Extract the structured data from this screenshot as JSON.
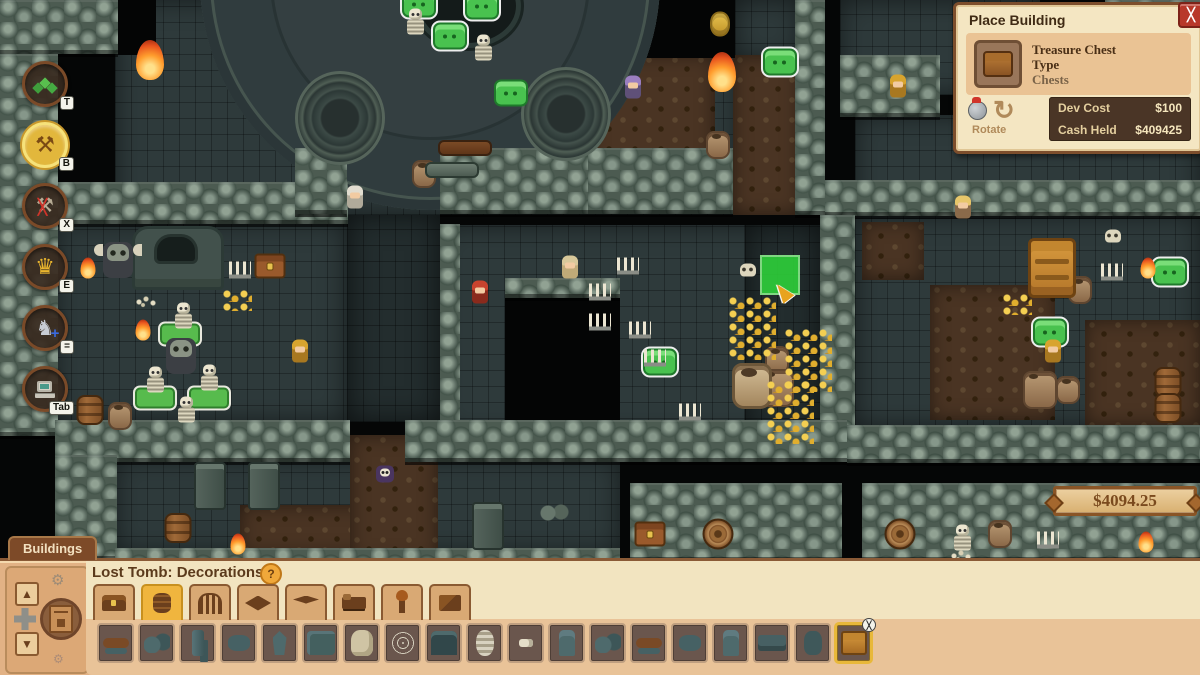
{
  "place_building_panel": {
    "title": "Place Building",
    "close_label": "╳",
    "item": {
      "line1": "Treasure Chest",
      "line2": "Type",
      "line3": "Chests"
    },
    "rotate_label": "Rotate",
    "rotate_glyph": "↻",
    "costs": [
      {
        "label": "Dev Cost",
        "value": "$100"
      },
      {
        "label": "Cash Held",
        "value": "$409425"
      }
    ]
  },
  "money_badge": {
    "amount": "$4094.25"
  },
  "toolbar": {
    "items": [
      {
        "id": "terrain",
        "glyph": "◆",
        "hotkey": "T",
        "selected": false
      },
      {
        "id": "build",
        "glyph": "⚒",
        "hotkey": "B",
        "selected": true
      },
      {
        "id": "demolish",
        "glyph": "⚒",
        "hotkey": "X",
        "selected": false
      },
      {
        "id": "crown",
        "glyph": "♛",
        "hotkey": "E",
        "selected": false
      },
      {
        "id": "knight",
        "glyph": "♞",
        "hotkey": "=",
        "selected": false
      },
      {
        "id": "computer",
        "glyph": "",
        "hotkey": "Tab",
        "selected": false
      }
    ]
  },
  "buildings_panel": {
    "tab_label": "Buildings",
    "header": "Lost Tomb: Decorations",
    "help_icon": "?",
    "gear_icon": "⚙",
    "arrow_up": "▲",
    "arrow_down": "▼",
    "categories": [
      {
        "id": "chests",
        "selected": false
      },
      {
        "id": "barrels",
        "selected": true
      },
      {
        "id": "gates",
        "selected": false
      },
      {
        "id": "carpets",
        "selected": false
      },
      {
        "id": "floors",
        "selected": false
      },
      {
        "id": "beds",
        "selected": false
      },
      {
        "id": "torches",
        "selected": false
      },
      {
        "id": "walls",
        "selected": false
      }
    ],
    "items": [
      {
        "variant": "log",
        "selected": false
      },
      {
        "variant": "rubble",
        "selected": false
      },
      {
        "variant": "pillar",
        "selected": false
      },
      {
        "variant": "rock",
        "selected": false
      },
      {
        "variant": "obelisk",
        "selected": false
      },
      {
        "variant": "wall",
        "selected": false
      },
      {
        "variant": "pelt",
        "selected": false
      },
      {
        "variant": "web",
        "selected": false
      },
      {
        "variant": "gate",
        "selected": false
      },
      {
        "variant": "swirl",
        "selected": false
      },
      {
        "variant": "tiny",
        "selected": false
      },
      {
        "variant": "statue",
        "selected": false
      },
      {
        "variant": "rubble",
        "selected": false
      },
      {
        "variant": "log",
        "selected": false
      },
      {
        "variant": "rock",
        "selected": false
      },
      {
        "variant": "statue",
        "selected": false
      },
      {
        "variant": "slab",
        "selected": false
      },
      {
        "variant": "sack",
        "selected": false
      },
      {
        "variant": "chest",
        "selected": true,
        "badge": "╳"
      }
    ]
  },
  "map": {
    "accent_colors": {
      "slime_green": "#49c24f",
      "placement_green": "#2ed43a",
      "gold": "#e0ae2e"
    },
    "floors": [
      {
        "x": 115,
        "y": 0,
        "w": 625,
        "h": 215,
        "k": "stone"
      },
      {
        "x": 590,
        "y": 55,
        "w": 125,
        "h": 115,
        "k": "dirt"
      },
      {
        "x": 735,
        "y": 0,
        "w": 65,
        "h": 60,
        "k": "stone"
      },
      {
        "x": 733,
        "y": 55,
        "w": 67,
        "h": 160,
        "k": "dirt"
      },
      {
        "x": 840,
        "y": 0,
        "w": 200,
        "h": 95,
        "k": "stone"
      },
      {
        "x": 855,
        "y": 115,
        "w": 345,
        "h": 100,
        "k": "stone"
      },
      {
        "x": 55,
        "y": 222,
        "w": 292,
        "h": 200,
        "k": "stone"
      },
      {
        "x": 347,
        "y": 215,
        "w": 93,
        "h": 207,
        "k": "stonedark"
      },
      {
        "x": 440,
        "y": 225,
        "w": 415,
        "h": 210,
        "k": "stone"
      },
      {
        "x": 745,
        "y": 225,
        "w": 75,
        "h": 210,
        "k": "stonedark"
      },
      {
        "x": 855,
        "y": 215,
        "w": 345,
        "h": 212,
        "k": "stone"
      },
      {
        "x": 930,
        "y": 285,
        "w": 125,
        "h": 135,
        "k": "dirt"
      },
      {
        "x": 1085,
        "y": 320,
        "w": 115,
        "h": 105,
        "k": "dirt"
      },
      {
        "x": 862,
        "y": 222,
        "w": 62,
        "h": 58,
        "k": "dirt"
      },
      {
        "x": 115,
        "y": 458,
        "w": 505,
        "h": 95,
        "k": "stone"
      },
      {
        "x": 240,
        "y": 505,
        "w": 175,
        "h": 50,
        "k": "dirt"
      },
      {
        "x": 350,
        "y": 435,
        "w": 88,
        "h": 125,
        "k": "dirt"
      },
      {
        "x": 118,
        "y": 0,
        "w": 38,
        "h": 55,
        "k": "dark"
      },
      {
        "x": 640,
        "y": 0,
        "w": 95,
        "h": 58,
        "k": "dark"
      },
      {
        "x": 1040,
        "y": 0,
        "w": 65,
        "h": 90,
        "k": "dark"
      },
      {
        "x": 505,
        "y": 295,
        "w": 115,
        "h": 140,
        "k": "dark"
      }
    ],
    "walls": [
      {
        "x": 0,
        "y": 0,
        "w": 118,
        "h": 54
      },
      {
        "x": 0,
        "y": 54,
        "w": 58,
        "h": 382
      },
      {
        "x": 58,
        "y": 182,
        "w": 290,
        "h": 42
      },
      {
        "x": 295,
        "y": 148,
        "w": 52,
        "h": 66
      },
      {
        "x": 440,
        "y": 148,
        "w": 148,
        "h": 66
      },
      {
        "x": 588,
        "y": 148,
        "w": 145,
        "h": 66
      },
      {
        "x": 795,
        "y": 0,
        "w": 30,
        "h": 215
      },
      {
        "x": 825,
        "y": 180,
        "w": 375,
        "h": 36
      },
      {
        "x": 840,
        "y": 55,
        "w": 100,
        "h": 62
      },
      {
        "x": 1105,
        "y": 0,
        "w": 95,
        "h": 95
      },
      {
        "x": 440,
        "y": 224,
        "w": 20,
        "h": 200
      },
      {
        "x": 820,
        "y": 215,
        "w": 35,
        "h": 220
      },
      {
        "x": 505,
        "y": 278,
        "w": 115,
        "h": 20
      },
      {
        "x": 55,
        "y": 420,
        "w": 295,
        "h": 42
      },
      {
        "x": 405,
        "y": 420,
        "w": 442,
        "h": 42
      },
      {
        "x": 847,
        "y": 425,
        "w": 353,
        "h": 38
      },
      {
        "x": 55,
        "y": 455,
        "w": 62,
        "h": 105
      },
      {
        "x": 630,
        "y": 483,
        "w": 212,
        "h": 78
      },
      {
        "x": 862,
        "y": 483,
        "w": 338,
        "h": 78
      },
      {
        "x": 115,
        "y": 548,
        "w": 505,
        "h": 20
      }
    ],
    "sprites": [
      {
        "t": "arena",
        "x": 430,
        "y": -20
      },
      {
        "t": "altar",
        "x": 468,
        "y": 6
      },
      {
        "t": "tower",
        "x": 340,
        "y": 118
      },
      {
        "t": "tower",
        "x": 566,
        "y": 114
      },
      {
        "t": "slime",
        "x": 419,
        "y": 4
      },
      {
        "t": "slime",
        "x": 482,
        "y": 6
      },
      {
        "t": "slime",
        "x": 450,
        "y": 36
      },
      {
        "t": "slime",
        "x": 511,
        "y": 93,
        "m": "plain"
      },
      {
        "t": "slime",
        "x": 780,
        "y": 62
      },
      {
        "t": "slime",
        "x": 660,
        "y": 362
      },
      {
        "t": "slime",
        "x": 1050,
        "y": 332
      },
      {
        "t": "slime",
        "x": 1170,
        "y": 272
      },
      {
        "t": "skeleton",
        "x": 415,
        "y": 22
      },
      {
        "t": "skeleton",
        "x": 483,
        "y": 48
      },
      {
        "t": "skeleton",
        "x": 183,
        "y": 316
      },
      {
        "t": "skeleton",
        "x": 155,
        "y": 380
      },
      {
        "t": "skeleton",
        "x": 209,
        "y": 378
      },
      {
        "t": "skeleton",
        "x": 186,
        "y": 410
      },
      {
        "t": "skeleton",
        "x": 962,
        "y": 538
      },
      {
        "t": "slab",
        "x": 180,
        "y": 334
      },
      {
        "t": "slab",
        "x": 155,
        "y": 398
      },
      {
        "t": "slab",
        "x": 209,
        "y": 398
      },
      {
        "t": "tomb",
        "x": 178,
        "y": 258
      },
      {
        "t": "skullstatue",
        "x": 118,
        "y": 260,
        "m": "winged"
      },
      {
        "t": "skullstatue",
        "x": 181,
        "y": 356
      },
      {
        "t": "chestwood",
        "x": 270,
        "y": 266
      },
      {
        "t": "chestwood",
        "x": 650,
        "y": 534
      },
      {
        "t": "chestgold",
        "x": 1052,
        "y": 268
      },
      {
        "t": "barrel",
        "x": 90,
        "y": 410
      },
      {
        "t": "barrel",
        "x": 178,
        "y": 528
      },
      {
        "t": "barrel",
        "x": 1168,
        "y": 382
      },
      {
        "t": "barrel",
        "x": 1168,
        "y": 408
      },
      {
        "t": "barrel",
        "x": 718,
        "y": 534,
        "m": "top"
      },
      {
        "t": "barrel",
        "x": 900,
        "y": 534,
        "m": "top"
      },
      {
        "t": "pot",
        "x": 120,
        "y": 416
      },
      {
        "t": "pot",
        "x": 424,
        "y": 174
      },
      {
        "t": "pot",
        "x": 718,
        "y": 145
      },
      {
        "t": "pot",
        "x": 777,
        "y": 360
      },
      {
        "t": "pot",
        "x": 777,
        "y": 388,
        "m": "big"
      },
      {
        "t": "pot",
        "x": 1080,
        "y": 290
      },
      {
        "t": "pot",
        "x": 1040,
        "y": 390,
        "m": "big"
      },
      {
        "t": "pot",
        "x": 1068,
        "y": 390
      },
      {
        "t": "pot",
        "x": 1000,
        "y": 534
      },
      {
        "t": "urn",
        "x": 752,
        "y": 386
      },
      {
        "t": "gold",
        "x": 752,
        "y": 328,
        "m": "big"
      },
      {
        "t": "gold",
        "x": 808,
        "y": 360,
        "m": "big"
      },
      {
        "t": "gold",
        "x": 790,
        "y": 412,
        "m": "big"
      },
      {
        "t": "gold",
        "x": 237,
        "y": 300
      },
      {
        "t": "gold",
        "x": 1017,
        "y": 304
      },
      {
        "t": "beehive",
        "x": 720,
        "y": 24
      },
      {
        "t": "flame",
        "x": 150,
        "y": 60,
        "m": "big"
      },
      {
        "t": "flame",
        "x": 722,
        "y": 72,
        "m": "big"
      },
      {
        "t": "flame",
        "x": 1014,
        "y": 60
      },
      {
        "t": "flame",
        "x": 88,
        "y": 268
      },
      {
        "t": "flame",
        "x": 143,
        "y": 330
      },
      {
        "t": "flame",
        "x": 238,
        "y": 544
      },
      {
        "t": "flame",
        "x": 1148,
        "y": 268
      },
      {
        "t": "flame",
        "x": 1146,
        "y": 542
      },
      {
        "t": "candles",
        "x": 240,
        "y": 270
      },
      {
        "t": "candles",
        "x": 628,
        "y": 266
      },
      {
        "t": "candles",
        "x": 600,
        "y": 292
      },
      {
        "t": "candles",
        "x": 600,
        "y": 322
      },
      {
        "t": "candles",
        "x": 640,
        "y": 330
      },
      {
        "t": "candles",
        "x": 655,
        "y": 358
      },
      {
        "t": "candles",
        "x": 690,
        "y": 412
      },
      {
        "t": "candles",
        "x": 1112,
        "y": 272
      },
      {
        "t": "candles",
        "x": 1048,
        "y": 540
      },
      {
        "t": "skull",
        "x": 748,
        "y": 270
      },
      {
        "t": "skull",
        "x": 1113,
        "y": 236
      },
      {
        "t": "bones",
        "x": 147,
        "y": 302
      },
      {
        "t": "bones",
        "x": 962,
        "y": 556
      },
      {
        "t": "log",
        "x": 465,
        "y": 148
      },
      {
        "t": "log",
        "x": 452,
        "y": 170,
        "m": "gray"
      },
      {
        "t": "char",
        "x": 633,
        "y": 88,
        "m": "purple"
      },
      {
        "t": "char",
        "x": 355,
        "y": 198,
        "m": "white"
      },
      {
        "t": "char",
        "x": 480,
        "y": 293,
        "m": "red"
      },
      {
        "t": "char",
        "x": 570,
        "y": 268,
        "m": "hooded"
      },
      {
        "t": "char",
        "x": 963,
        "y": 208,
        "m": "blonde"
      },
      {
        "t": "char",
        "x": 898,
        "y": 87,
        "m": "gold"
      },
      {
        "t": "char",
        "x": 300,
        "y": 352,
        "m": "gold"
      },
      {
        "t": "char",
        "x": 1053,
        "y": 352,
        "m": "gold"
      },
      {
        "t": "imp",
        "x": 385,
        "y": 474
      },
      {
        "t": "pillar",
        "x": 210,
        "y": 486
      },
      {
        "t": "pillar",
        "x": 264,
        "y": 486
      },
      {
        "t": "pillar",
        "x": 488,
        "y": 526
      },
      {
        "t": "rocks",
        "x": 555,
        "y": 512
      },
      {
        "t": "placetile",
        "x": 780,
        "y": 275
      },
      {
        "t": "cursor",
        "x": 783,
        "y": 292
      }
    ]
  }
}
